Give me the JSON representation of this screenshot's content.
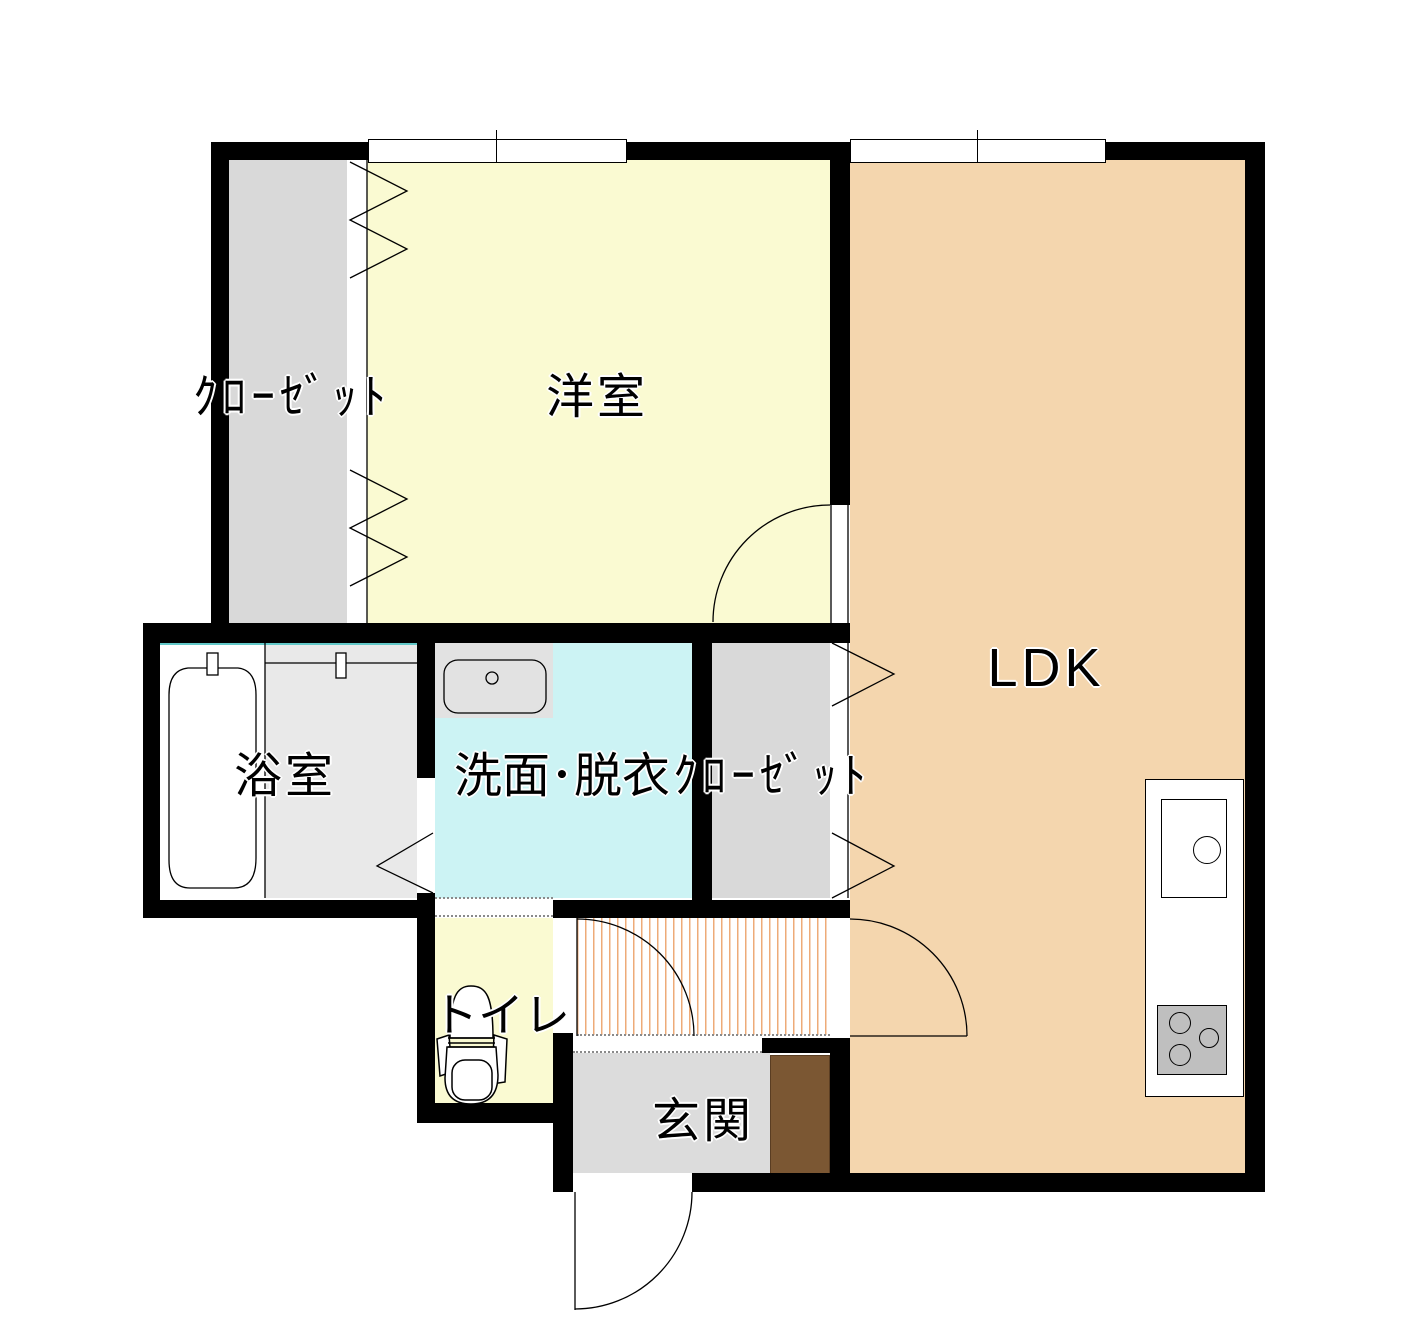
{
  "floor_plan": {
    "rooms": [
      {
        "key": "closet_upper",
        "label": "ｸﾛｰｾﾞｯﾄ",
        "color": "#d9d9d9"
      },
      {
        "key": "western_room",
        "label": "洋室",
        "color": "#fafad2"
      },
      {
        "key": "ldk",
        "label": "LDK",
        "color": "#f4d6ae"
      },
      {
        "key": "bathroom",
        "label": "浴室",
        "color": "#e9e9e9"
      },
      {
        "key": "washroom",
        "label": "洗面･脱衣",
        "color": "#ccf3f4"
      },
      {
        "key": "closet_middle",
        "label": "ｸﾛｰｾﾞｯﾄ",
        "color": "#d9d9d9"
      },
      {
        "key": "toilet",
        "label": "トイレ",
        "color": "#fafad2"
      },
      {
        "key": "entrance",
        "label": "玄関",
        "color": "#dcdcdc"
      }
    ],
    "colors": {
      "wall": "#000000",
      "hallway_stripe": "#eeab78",
      "bath_unit_edge": "#62c8c8",
      "shoe_cabinet": "#7b5733",
      "stove": "#bfbfbf"
    },
    "fixtures": [
      "bathtub",
      "wash-basin",
      "toilet",
      "kitchen-counter",
      "kitchen-sink",
      "stove",
      "shoe-cabinet"
    ]
  }
}
